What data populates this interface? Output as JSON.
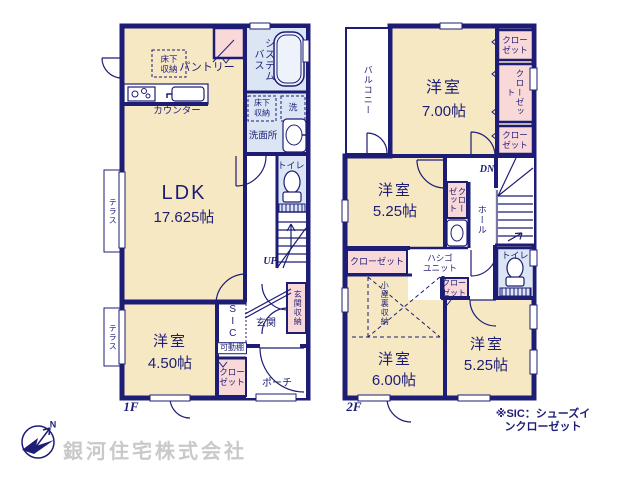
{
  "colors": {
    "wall": "#1d1d76",
    "room_cream": "#f6e8c3",
    "closet_pink": "#f9d8d8",
    "wet_blue": "#dbe5f4",
    "company_gray": "#c9c9c9"
  },
  "f1": {
    "floor": "1F",
    "ldk_name": "LDK",
    "ldk_size": "17.625帖",
    "pantry": "パントリー",
    "counter": "カウンター",
    "underfloor": "床下\n収納",
    "system_bath": "システムバス",
    "washer": "洗",
    "washroom": "洗面所",
    "toilet": "トイレ",
    "up": "UP",
    "genkan": "玄関",
    "genkan_storage": "玄関収納",
    "sic": "SIC",
    "shelf": "可動棚",
    "closet2": "クロー\nゼット",
    "room450_name": "洋室",
    "room450_size": "4.50帖",
    "porch": "ポーチ",
    "terrace": "テラス"
  },
  "f2": {
    "floor": "2F",
    "balcony": "バルコニー",
    "room700_name": "洋室",
    "room700_size": "7.00帖",
    "room525a_name": "洋室",
    "room525a_size": "5.25帖",
    "room600_name": "洋室",
    "room600_size": "6.00帖",
    "room525b_name": "洋室",
    "room525b_size": "5.25帖",
    "closet": "クローゼット",
    "closet2": "クロー\nゼット",
    "ladder": "ハシゴ\nユニット",
    "attic": "小屋裏収納",
    "hall": "ホール",
    "dn": "DN",
    "toilet": "トイレ"
  },
  "footer": {
    "note": "※SIC：シューズインクローゼット",
    "company": "銀河住宅株式会社",
    "north": "N"
  }
}
